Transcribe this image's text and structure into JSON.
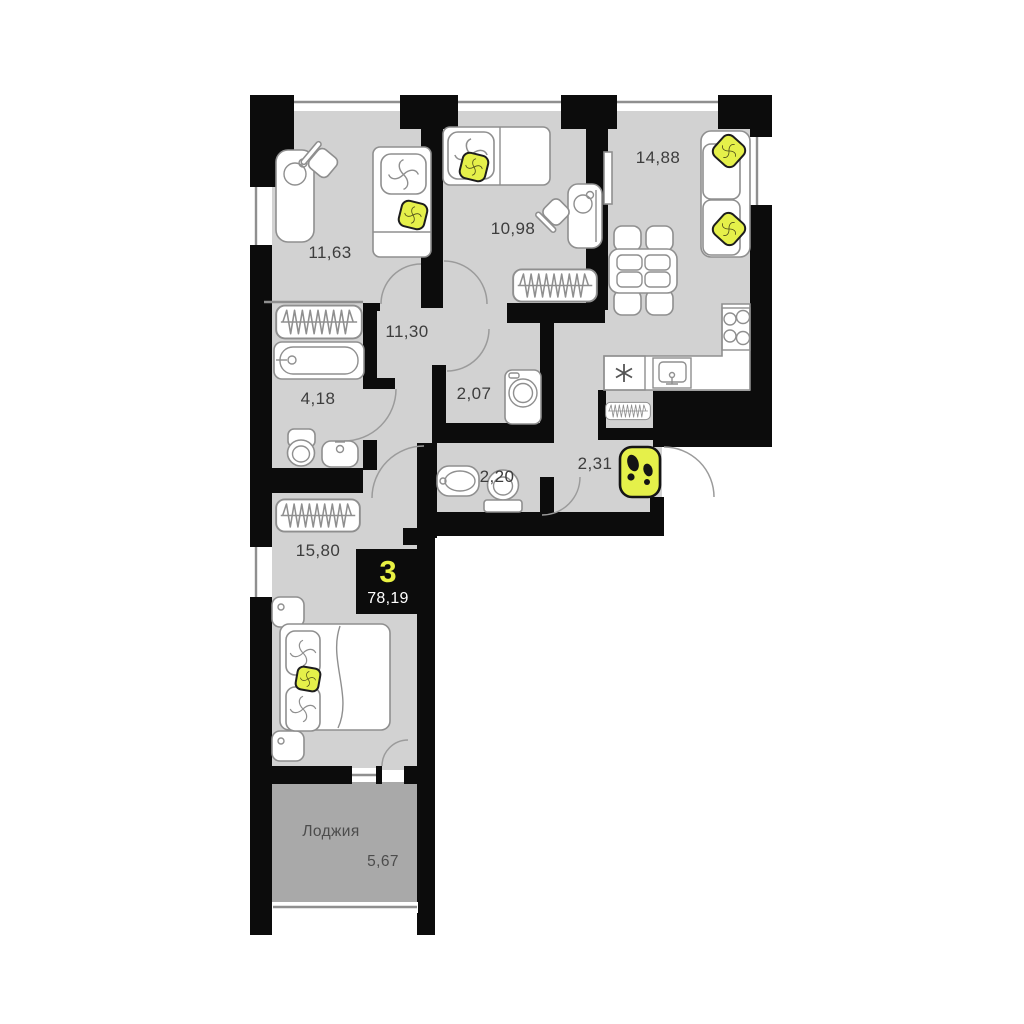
{
  "badge": {
    "rooms_count": "3",
    "total_area": "78,19"
  },
  "rooms": [
    {
      "id": "bedroom-1",
      "area": "11,63"
    },
    {
      "id": "bedroom-2",
      "area": "10,98"
    },
    {
      "id": "living-room-kitchen",
      "area": "14,88"
    },
    {
      "id": "corridor",
      "area": "11,30"
    },
    {
      "id": "bathroom",
      "area": "4,18"
    },
    {
      "id": "toilet",
      "area": "2,07"
    },
    {
      "id": "wc",
      "area": "2,20"
    },
    {
      "id": "entrance-hall",
      "area": "2,31"
    },
    {
      "id": "bedroom-3",
      "area": "15,80"
    },
    {
      "id": "loggia",
      "label": "Лоджия",
      "area": "5,67"
    }
  ],
  "colors": {
    "accent_yellow": "#e5f04a",
    "room_fill": "#d2d2d2",
    "loggia_fill": "#a9a9a9",
    "wall": "#0c0c0c"
  }
}
